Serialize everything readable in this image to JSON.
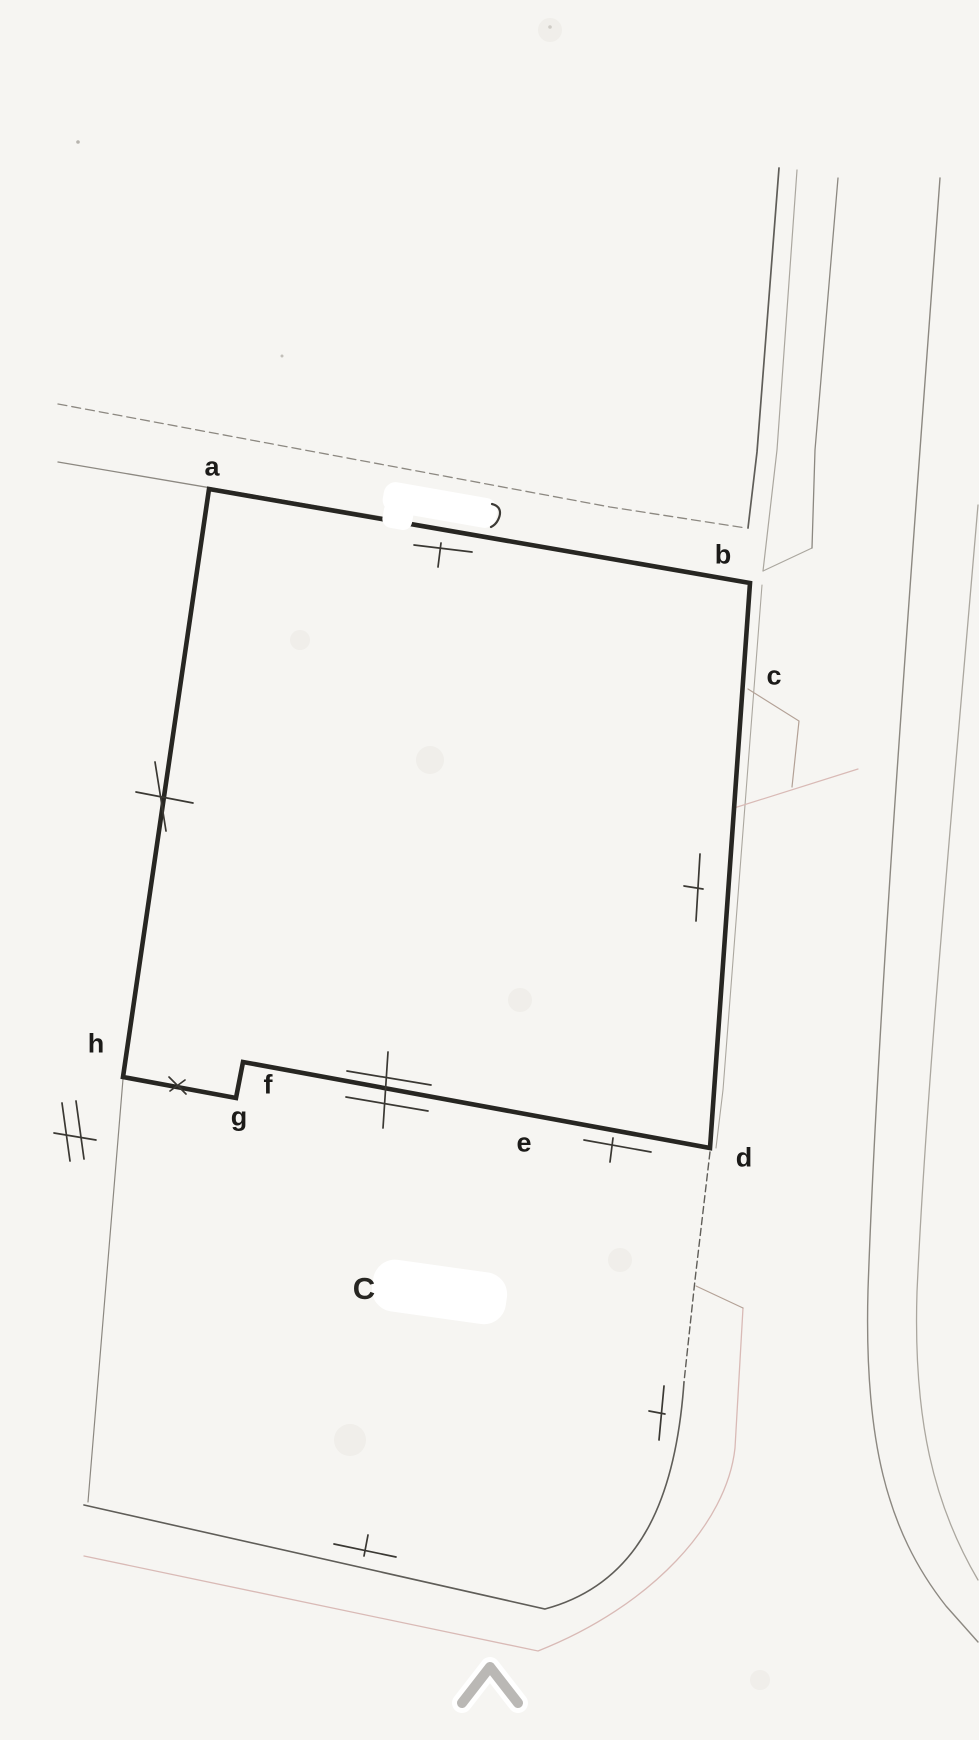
{
  "page": {
    "width": 979,
    "height": 1740
  },
  "colors": {
    "paper": "#f6f5f2",
    "ink": "#272622",
    "tick": "#3a3833",
    "label": "#1c1b19",
    "road_dark": "#5f5d58",
    "road_mid": "#8c8881",
    "road_light": "#aba79f",
    "tan": "#b3a196",
    "pink": "#d9bab6",
    "chevron": "#bab8b5",
    "patch": "#ffffff"
  },
  "parcel": {
    "outline_corner_ids": [
      "a",
      "b",
      "d",
      "f",
      "g",
      "h"
    ],
    "points": {
      "a": {
        "label": "a",
        "x": 209,
        "y": 489,
        "css": "left:212px;top:467px"
      },
      "b": {
        "label": "b",
        "x": 750,
        "y": 583,
        "css": "left:723px;top:555px"
      },
      "c": {
        "label": "c",
        "css": "left:774px;top:676px"
      },
      "d": {
        "label": "d",
        "x": 710,
        "y": 1148,
        "css": "left:744px;top:1158px"
      },
      "e": {
        "label": "e",
        "css": "left:524px;top:1143px"
      },
      "f": {
        "label": "f",
        "x": 243,
        "y": 1062,
        "css": "left:268px;top:1085px"
      },
      "g": {
        "label": "g",
        "x": 236,
        "y": 1098,
        "css": "left:239px;top:1117px"
      },
      "h": {
        "label": "h",
        "x": 123,
        "y": 1077,
        "css": "left:96px;top:1044px"
      }
    }
  },
  "annotations": {
    "erased_label_fragment": "C",
    "erased_label_css": "left:364px;top:1289px"
  },
  "icons": {
    "chevron_up": {
      "meaning": "scroll up indicator"
    }
  }
}
